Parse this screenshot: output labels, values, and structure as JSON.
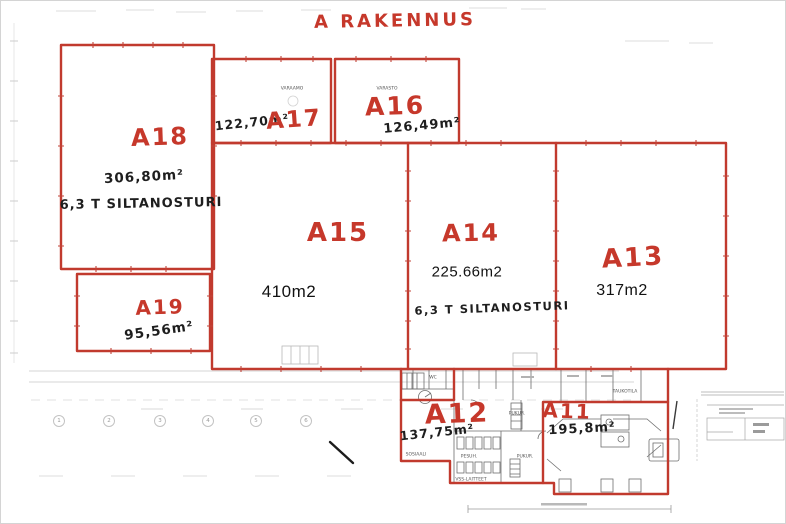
{
  "page": {
    "title": "A RAKENNUS"
  },
  "colors": {
    "marker_red": "#c6382b",
    "handwriting_black": "#1e1e1e",
    "typed_black": "#121212",
    "print_gray": "#6e6e6e",
    "faint_gray": "#cfcfcf"
  },
  "rooms": [
    {
      "id": "A18",
      "label": "A18",
      "area": "306,80m²",
      "note": "6,3 T SILTANOSTURI"
    },
    {
      "id": "A17",
      "label": "A17",
      "area": "122,70m²",
      "small_print": "VARAAMO"
    },
    {
      "id": "A16",
      "label": "A16",
      "area": "126,49m²",
      "small_print": "VARASTO"
    },
    {
      "id": "A15",
      "label": "A15",
      "area": "410m2"
    },
    {
      "id": "A14",
      "label": "A14",
      "area": "225.66m2",
      "note": "6,3 T SILTANOSTURI"
    },
    {
      "id": "A13",
      "label": "A13",
      "area": "317m2"
    },
    {
      "id": "A19",
      "label": "A19",
      "area": "95,56m²"
    },
    {
      "id": "A12",
      "label": "A12",
      "area": "137,75m²"
    },
    {
      "id": "A11",
      "label": "A11",
      "area": "195,8m²"
    }
  ],
  "printed_labels": {
    "wing": [
      "SOSIAALI",
      "PESUH.",
      "VSS-LAITTEET",
      "PUKUR.",
      "PUKUR.",
      "TAUKOTILA",
      "WC"
    ]
  },
  "grid_axis_numbers": [
    "1",
    "2",
    "3",
    "4",
    "5",
    "6"
  ]
}
